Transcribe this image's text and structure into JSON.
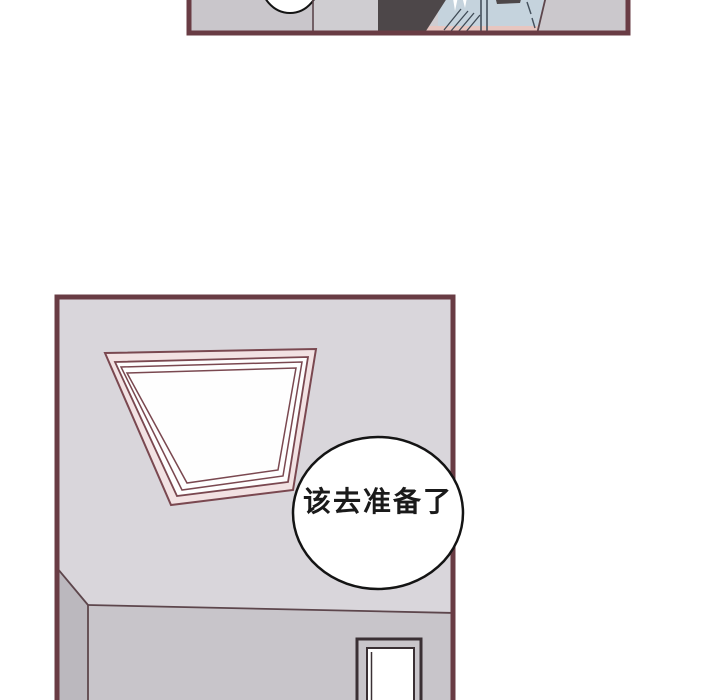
{
  "page": {
    "background": "#ffffff",
    "kind_label": "comic page"
  },
  "colors": {
    "page_bg": "#ffffff",
    "panel_border": "#693c44",
    "wall_gray_a": "#c9c6cb",
    "wall_gray_b": "#cfcdd1",
    "wall_gray_c": "#cbc8cc",
    "shirt_blue": "#c5d3dd",
    "hair_dark": "#4d4749",
    "skin_pink": "#e7c6c0",
    "fold_line": "#3f4a55",
    "seam_line": "#44505c",
    "wall_line": "#5d464c",
    "ceiling": "#d9d6db",
    "side_wall": "#bbb8be",
    "front_wall": "#c8c5ca",
    "frame_line": "#7a4850",
    "frame_fill_pink": "#f2e2e3",
    "glass_white": "#fefefe",
    "bubble_fill": "#ffffff",
    "bubble_stroke": "#141414",
    "door_line": "#3a3034",
    "text_color": "#1a1a1a"
  },
  "panels": {
    "main_panel": {
      "bubble_text": "该去准备了"
    }
  }
}
